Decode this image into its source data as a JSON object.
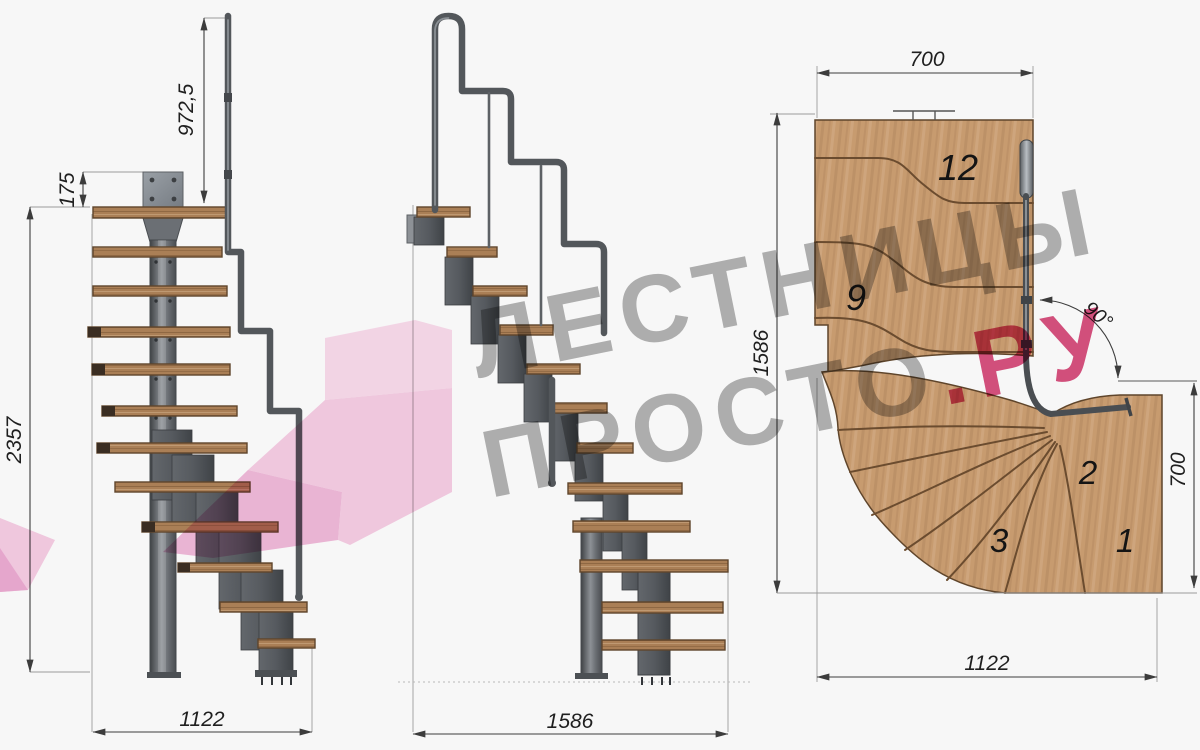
{
  "watermark": {
    "line1": "ЛЕСТНИЦЫ",
    "line2_gray": "ПРОСТО",
    "line2_pink": ".РУ"
  },
  "left_view": {
    "dim_rail_height": "972,5",
    "dim_plate": "175",
    "dim_total_height": "2357",
    "dim_width": "1122"
  },
  "middle_view": {
    "dim_width": "1586"
  },
  "plan_view": {
    "dim_top": "700",
    "dim_left": "1586",
    "dim_right": "700",
    "dim_bottom": "1122",
    "angle": "90°",
    "steps": {
      "s12": "12",
      "s9": "9",
      "s3": "3",
      "s2": "2",
      "s1": "1"
    }
  },
  "colors": {
    "wood_side": "#aa7f56",
    "wood_plan": "#c79b6f",
    "metal": "#54585c",
    "dimension": "#3c3c3c",
    "watermark_gray": "#b3b3b3",
    "watermark_pink": "#d8517f",
    "arrow_pink": "#f6c9e2"
  }
}
